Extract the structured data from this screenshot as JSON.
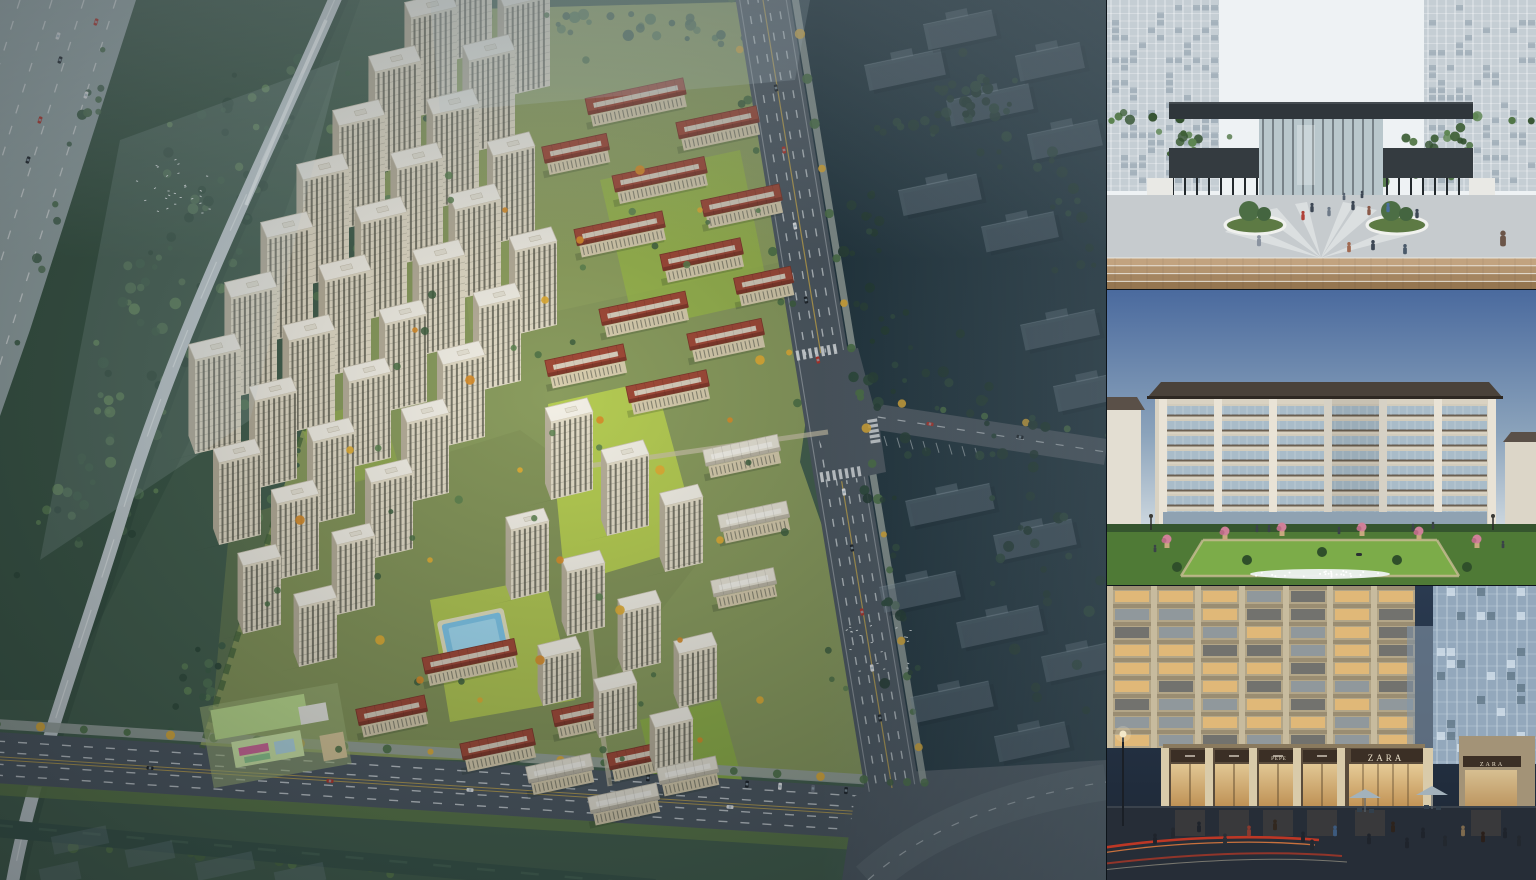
{
  "street": {
    "signs": [
      "PEPE",
      "ZARA",
      "ZARA"
    ]
  },
  "palette": {
    "aerial": {
      "base_green": "#44604e",
      "forest": "#3c5847",
      "ghost_bg": "#22363f",
      "site_green": "#8a9c5e",
      "lawn": "#b7cf52",
      "lawn2": "#9dbd49",
      "road": "#4e5962",
      "sidewalk": "#9aa59f",
      "highway": "#a2b0b2",
      "elevated": "#c6d0d3",
      "lane_white": "#dbe1e4",
      "lane_yellow": "#c8a94e",
      "tower_face": "#e4ddc8",
      "tower_side": "#b8b09b",
      "tower_window": "#606052",
      "roof_white": "#f3f0e6",
      "red_roof": "#a14a38",
      "red_roof_dark": "#7e372a",
      "ridge": "#d9cfbe",
      "ghost_slab": "#7d8f9b",
      "mist": "#cfe0e6",
      "canal": "#3a564a",
      "pool": "#7fc6e8",
      "pool_light": "#a5dcf2",
      "tree_green": "#4e7247",
      "tree_yellow": "#e2ae35",
      "tree_orange": "#d98e2b",
      "kindergarten_roof": "#bcdc8e",
      "kindergarten_roof2": "#cfe8a8",
      "car_red": "#b5342a",
      "car_white": "#e8eaec",
      "car_dark": "#20262c"
    },
    "plaza": {
      "sky": "#eef2f4",
      "tower": "#c5ced4",
      "tower_cell": "#8fa0ac",
      "pavilion": "#2f363b",
      "colonnade": "#343b40",
      "glass": "#b9c7cc",
      "ground": "#c6cbce",
      "pattern": "#e9ecec",
      "parapet": "#e9e9e5",
      "wood1": "#c2a37f",
      "wood2": "#b3946f",
      "wood3": "#a48560",
      "wood4": "#957650",
      "tree": "#4c6e45"
    },
    "garden": {
      "sky_top": "#4a6a9e",
      "sky_mid": "#8ba3bb",
      "sky_bottom": "#cfd9e0",
      "pier": "#e9e3d6",
      "body": "#d9d2c2",
      "spandrel": "#6e5f4d",
      "glass": "#a7bac9",
      "roof": "#4a423a",
      "lawn": "#7cac49",
      "garden_base": "#4f7a36",
      "hedge": "#35552e",
      "flower_pink": "#cf8098",
      "flower_white": "#eef2f2",
      "urn": "#c7a97e"
    },
    "street": {
      "bg_top": "#2a3a50",
      "bg_bottom": "#1c2633",
      "facade": "#b3a688",
      "pier": "#c7bb9e",
      "slab": "#9a8d72",
      "window_warm": "#e7bb76",
      "window_cool": "#7890aa",
      "sign_band": "#3b2f25",
      "glass_glow": "#edd29c",
      "retail_pier": "#d9cbaa",
      "ground": "#262d37",
      "umbrella": "#a3b2bb",
      "trail_red": "#d83a22",
      "trail_orange": "#f2823e",
      "tower_glass": "#93a8bc",
      "tower_mullion": "#ccd8e2"
    }
  }
}
